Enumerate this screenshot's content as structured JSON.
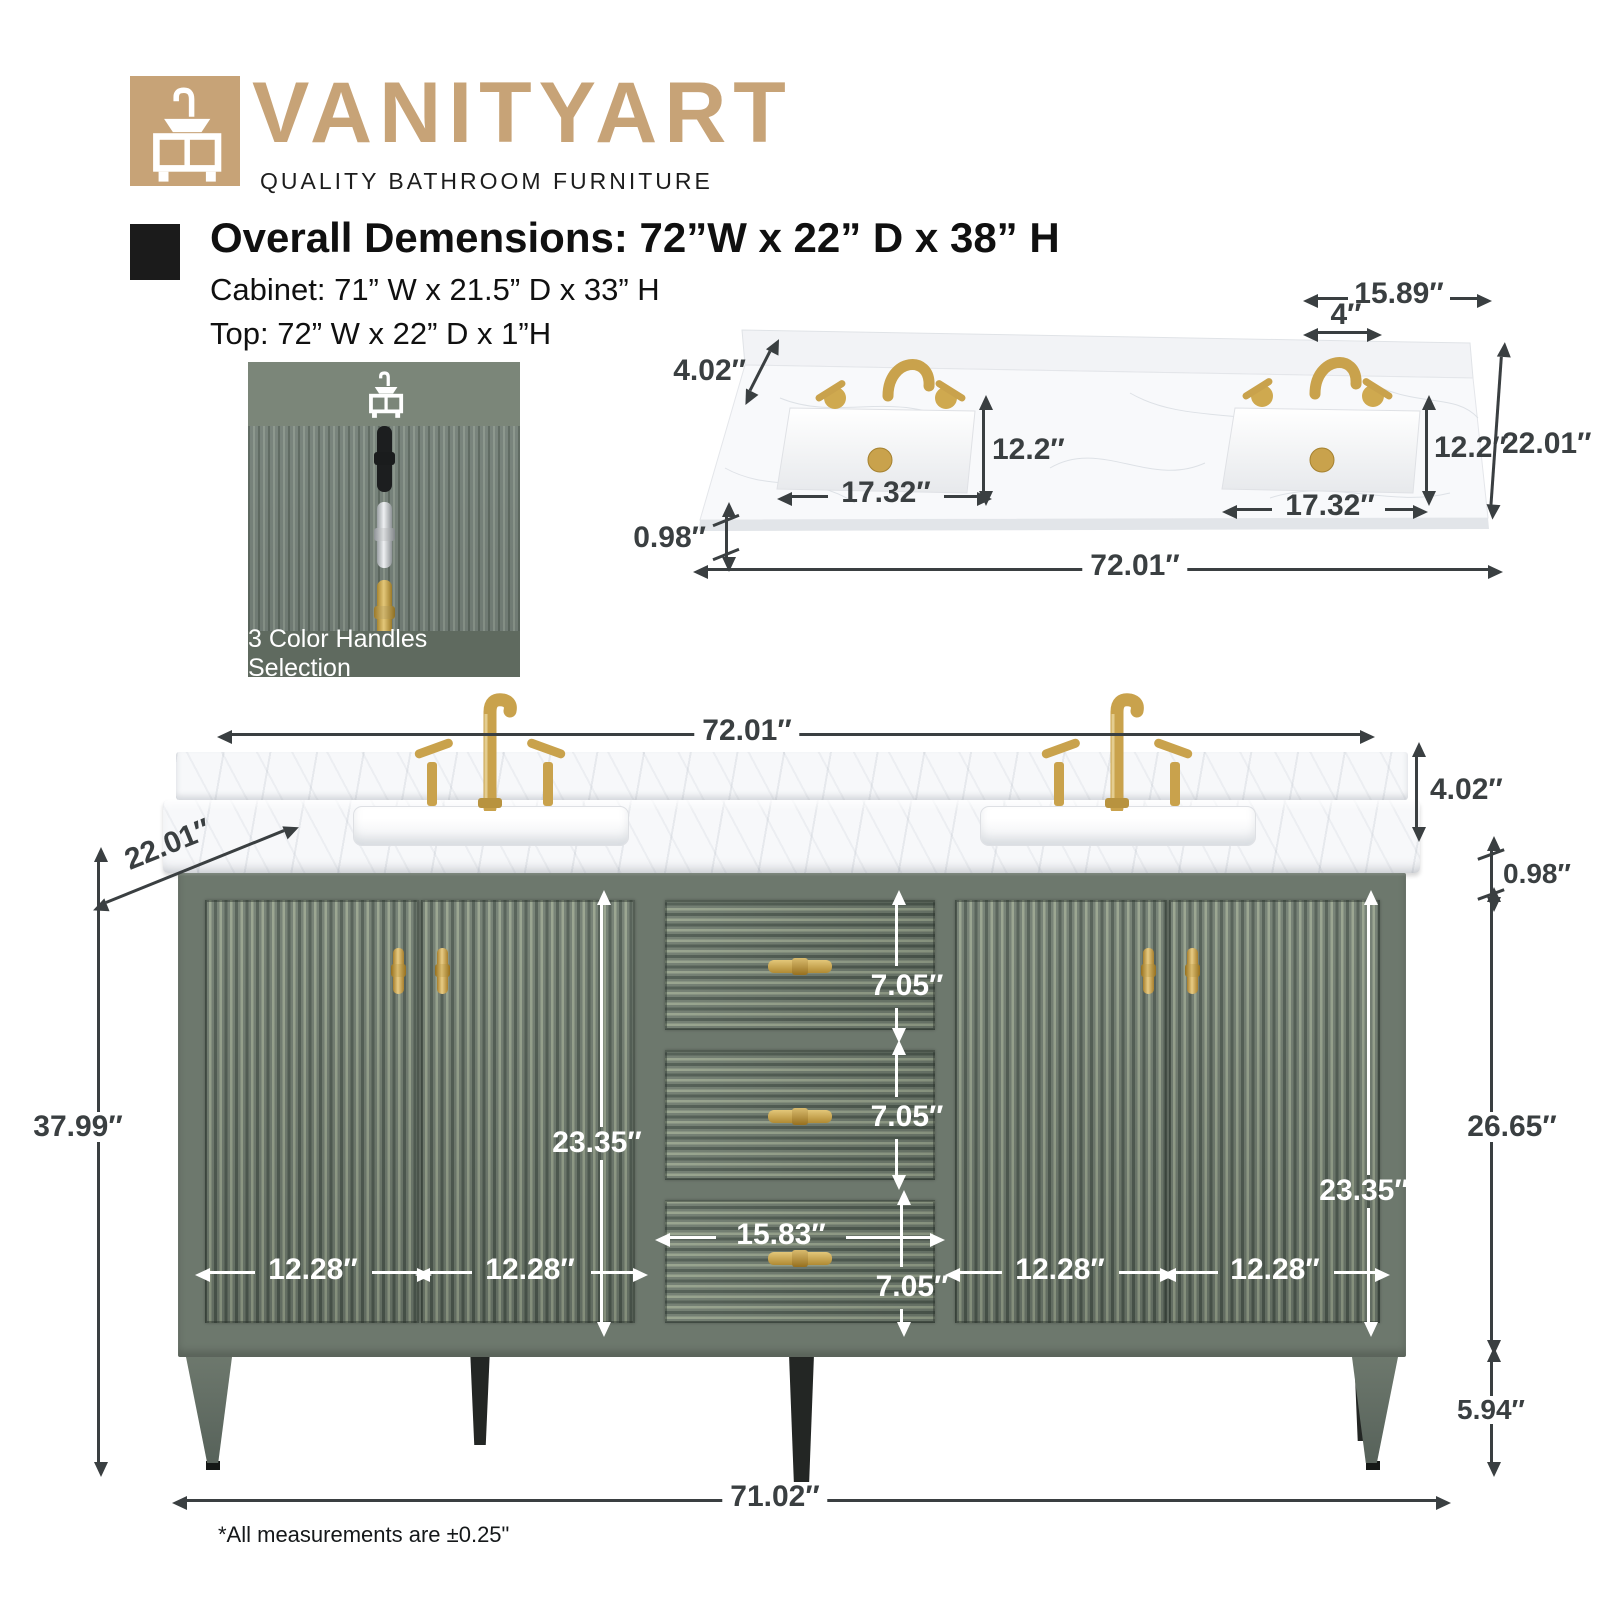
{
  "colors": {
    "brand_tan": "#c7a377",
    "cabinet_green": "#6d786d",
    "gold": "#c9a24c",
    "dimension_dark": "#3a3f41",
    "dimension_white": "#ffffff"
  },
  "header": {
    "brand": "VANITYART",
    "tagline": "QUALITY BATHROOM FURNITURE"
  },
  "specs": {
    "overall": "Overall Demensions: 72”W x 22” D x 38” H",
    "cabinet": "Cabinet: 71” W x 21.5” D x 33” H",
    "top": "Top: 72” W x 22” D x 1”H"
  },
  "swatch": {
    "caption": "3 Color Handles Selection",
    "handles": [
      "black",
      "chrome",
      "gold"
    ]
  },
  "top_view": {
    "back_width": "15.89″",
    "faucet_spread": "4″",
    "backsplash_height": "4.02″",
    "sink_depth_left": "12.2″",
    "sink_depth_right": "12.2″",
    "depth": "22.01″",
    "sink_width_left": "17.32″",
    "sink_width_right": "17.32″",
    "thickness": "0.98″",
    "width": "72.01″"
  },
  "front_view": {
    "width": "72.01″",
    "depth": "22.01″",
    "height": "37.99″",
    "backsplash_height": "4.02″",
    "thickness": "0.98″",
    "cabinet_height": "26.65″",
    "leg_height": "5.94″",
    "base_width": "71.02″",
    "door_height_left": "23.35″",
    "door_height_right": "23.35″",
    "drawer_heights": [
      "7.05″",
      "7.05″",
      "7.05″"
    ],
    "drawer_width": "15.83″",
    "door_widths": [
      "12.28″",
      "12.28″",
      "12.28″",
      "12.28″"
    ]
  },
  "footnote": "*All measurements are ±0.25\""
}
